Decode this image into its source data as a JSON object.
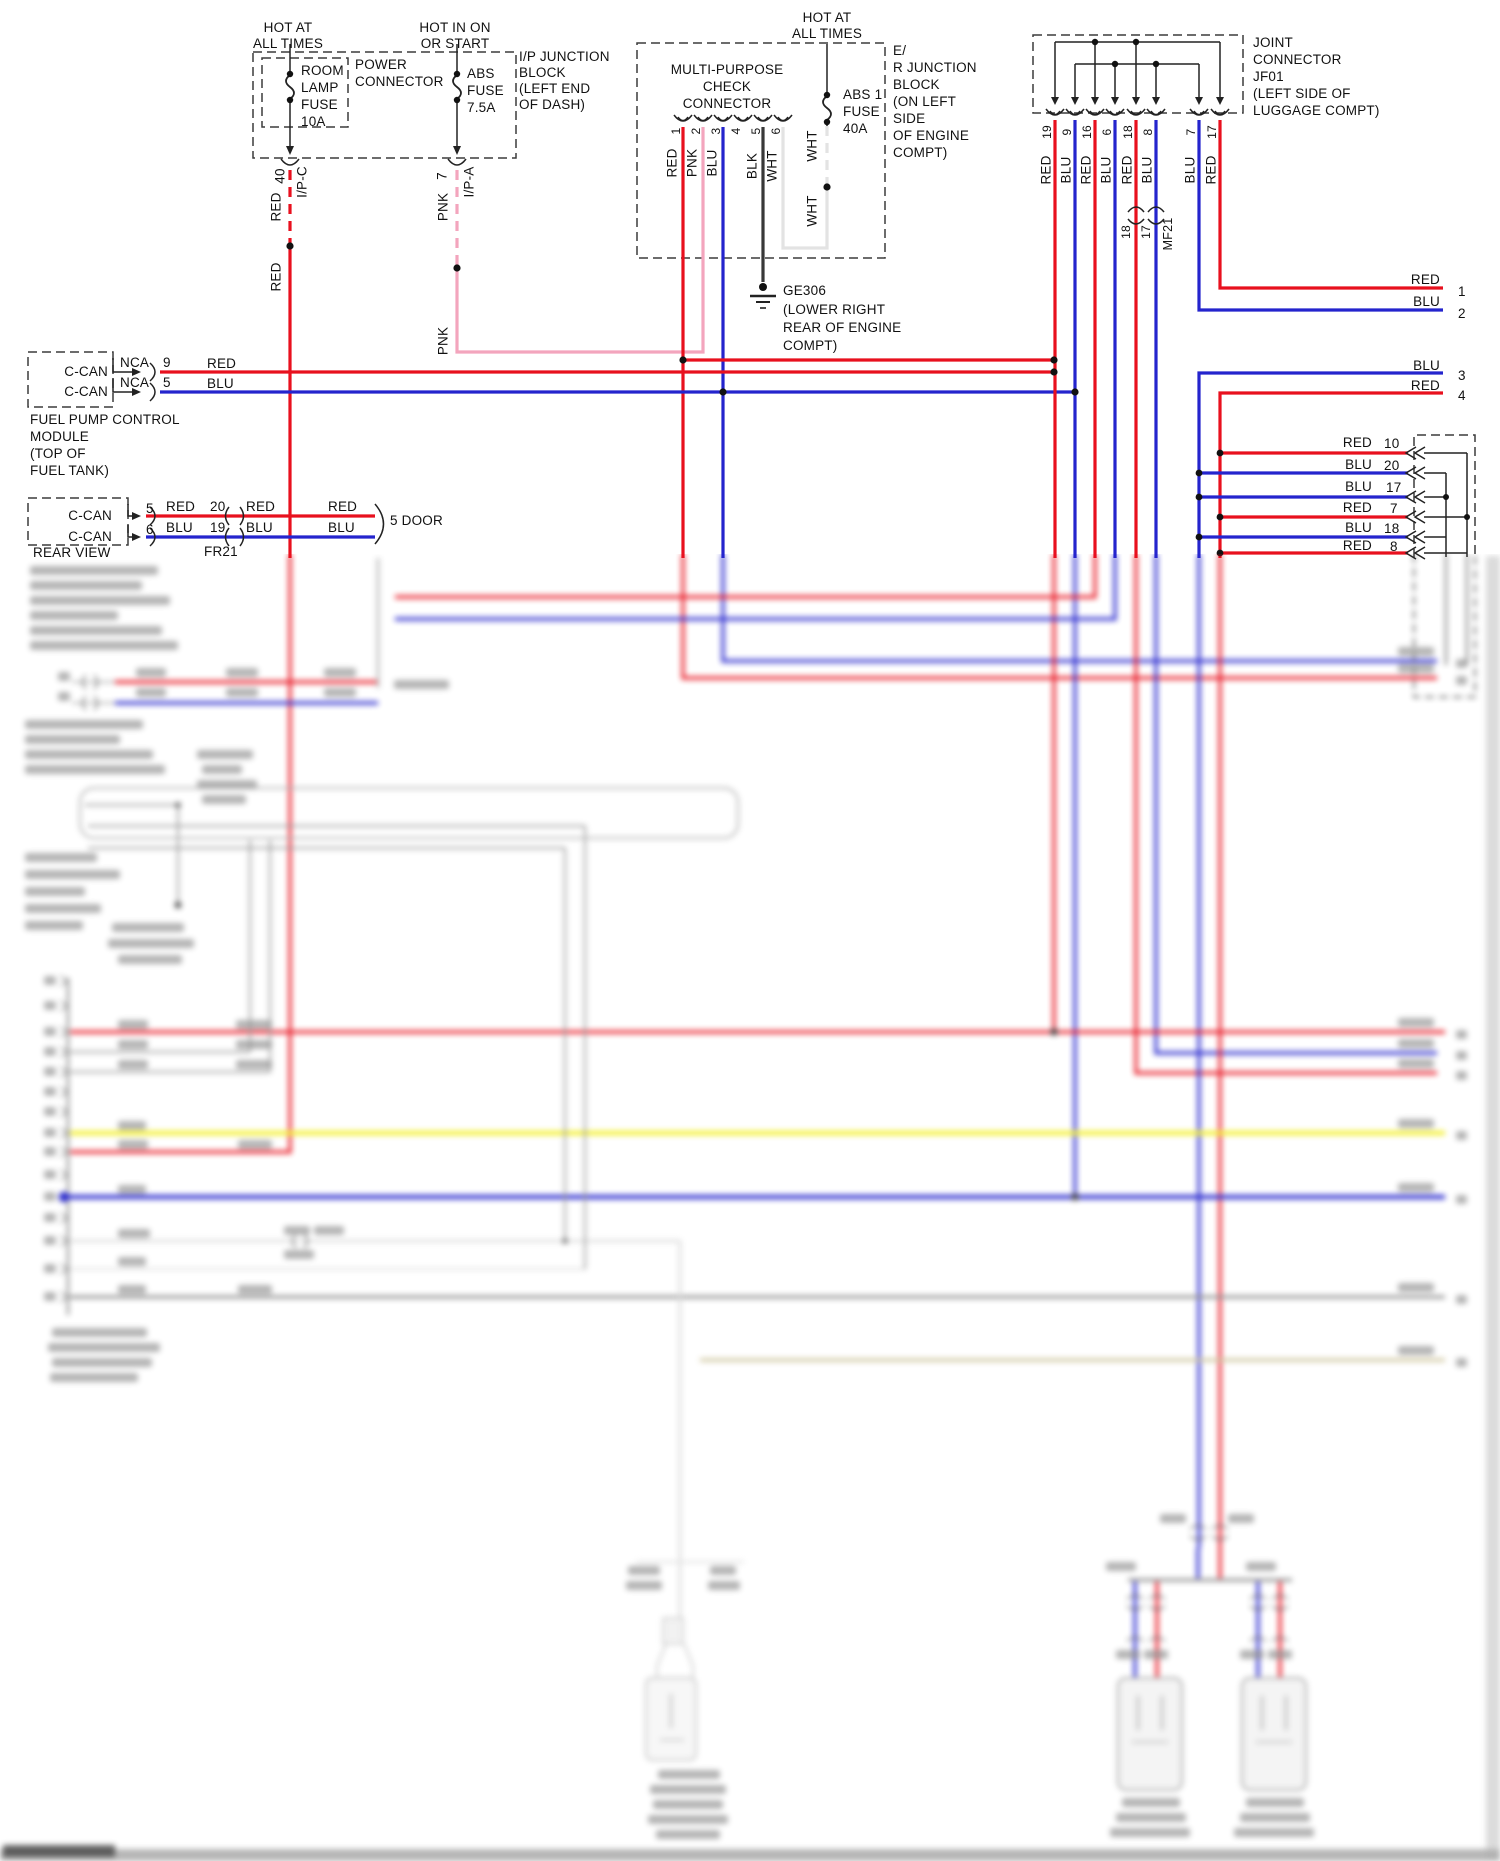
{
  "colors": {
    "red": "#e8101e",
    "blu": "#2424cd",
    "pnk": "#f3a5bd",
    "wht": "#e3e3e3",
    "blk": "#383838",
    "line": "#222222",
    "yel": "#f2ee1f",
    "gry": "#8f8f8f",
    "tan": "#cdc39a",
    "blob": "#8a8a8a",
    "boxline": "#3c3c3c"
  },
  "components": [
    {
      "name": "ip-junction-block",
      "labels": [
        {
          "t": "HOT AT",
          "x": 288,
          "y": 21,
          "a": "ct"
        },
        {
          "t": "ALL TIMES",
          "x": 288,
          "y": 37,
          "a": "ct"
        },
        {
          "t": "HOT IN ON",
          "x": 455,
          "y": 21,
          "a": "ct"
        },
        {
          "t": "OR START",
          "x": 455,
          "y": 37,
          "a": "ct"
        },
        {
          "t": "ROOM",
          "x": 301,
          "y": 64
        },
        {
          "t": "LAMP",
          "x": 301,
          "y": 81
        },
        {
          "t": "FUSE",
          "x": 301,
          "y": 98
        },
        {
          "t": "10A",
          "x": 301,
          "y": 115
        },
        {
          "t": "POWER",
          "x": 355,
          "y": 58
        },
        {
          "t": "CONNECTOR",
          "x": 355,
          "y": 75
        },
        {
          "t": "ABS",
          "x": 467,
          "y": 67
        },
        {
          "t": "FUSE",
          "x": 467,
          "y": 84
        },
        {
          "t": "7.5A",
          "x": 467,
          "y": 101
        },
        {
          "t": "I/P JUNCTION",
          "x": 519,
          "y": 50
        },
        {
          "t": "BLOCK",
          "x": 519,
          "y": 66
        },
        {
          "t": "(LEFT END",
          "x": 519,
          "y": 82
        },
        {
          "t": "OF DASH)",
          "x": 519,
          "y": 98
        },
        {
          "t": "40",
          "x": 280,
          "y": 176,
          "r": 1
        },
        {
          "t": "I/P-C",
          "x": 302,
          "y": 182,
          "r": 1
        },
        {
          "t": "RED",
          "x": 276,
          "y": 207,
          "r": 1
        },
        {
          "t": "RED",
          "x": 276,
          "y": 277,
          "r": 1
        },
        {
          "t": "7",
          "x": 442,
          "y": 176,
          "r": 1
        },
        {
          "t": "I/P-A",
          "x": 469,
          "y": 182,
          "r": 1
        },
        {
          "t": "PNK",
          "x": 443,
          "y": 207,
          "r": 1
        },
        {
          "t": "PNK",
          "x": 443,
          "y": 341,
          "r": 1
        }
      ]
    },
    {
      "name": "er-junction-block",
      "labels": [
        {
          "t": "HOT AT",
          "x": 827,
          "y": 11,
          "a": "ct"
        },
        {
          "t": "ALL TIMES",
          "x": 827,
          "y": 27,
          "a": "ct"
        },
        {
          "t": "MULTI-PURPOSE",
          "x": 727,
          "y": 63,
          "a": "ct"
        },
        {
          "t": "CHECK",
          "x": 727,
          "y": 80,
          "a": "ct"
        },
        {
          "t": "CONNECTOR",
          "x": 727,
          "y": 97,
          "a": "ct"
        },
        {
          "t": "1",
          "x": 676,
          "y": 131,
          "r": 1,
          "s": 12
        },
        {
          "t": "2",
          "x": 696,
          "y": 131,
          "r": 1,
          "s": 12
        },
        {
          "t": "3",
          "x": 716,
          "y": 131,
          "r": 1,
          "s": 12
        },
        {
          "t": "4",
          "x": 736,
          "y": 131,
          "r": 1,
          "s": 12
        },
        {
          "t": "5",
          "x": 756,
          "y": 131,
          "r": 1,
          "s": 12
        },
        {
          "t": "6",
          "x": 776,
          "y": 131,
          "r": 1,
          "s": 12
        },
        {
          "t": "RED",
          "x": 672,
          "y": 163,
          "r": 1
        },
        {
          "t": "PNK",
          "x": 692,
          "y": 163,
          "r": 1
        },
        {
          "t": "BLU",
          "x": 712,
          "y": 163,
          "r": 1
        },
        {
          "t": "BLK",
          "x": 752,
          "y": 166,
          "r": 1
        },
        {
          "t": "WHT",
          "x": 772,
          "y": 166,
          "r": 1
        },
        {
          "t": "ABS 1",
          "x": 843,
          "y": 88
        },
        {
          "t": "FUSE",
          "x": 843,
          "y": 105
        },
        {
          "t": "40A",
          "x": 843,
          "y": 122
        },
        {
          "t": "WHT",
          "x": 812,
          "y": 146,
          "r": 1
        },
        {
          "t": "WHT",
          "x": 812,
          "y": 211,
          "r": 1
        },
        {
          "t": "E/",
          "x": 893,
          "y": 44
        },
        {
          "t": "R JUNCTION",
          "x": 893,
          "y": 61
        },
        {
          "t": "BLOCK",
          "x": 893,
          "y": 78
        },
        {
          "t": "(ON LEFT",
          "x": 893,
          "y": 95
        },
        {
          "t": "SIDE",
          "x": 893,
          "y": 112
        },
        {
          "t": "OF ENGINE",
          "x": 893,
          "y": 129
        },
        {
          "t": "COMPT)",
          "x": 893,
          "y": 146
        }
      ]
    },
    {
      "name": "ge306-ground",
      "labels": [
        {
          "t": "GE306",
          "x": 783,
          "y": 284
        },
        {
          "t": "(LOWER RIGHT",
          "x": 783,
          "y": 303
        },
        {
          "t": "REAR OF ENGINE",
          "x": 783,
          "y": 321
        },
        {
          "t": "COMPT)",
          "x": 783,
          "y": 339
        }
      ]
    },
    {
      "name": "jf01-joint-connector",
      "labels": [
        {
          "t": "JOINT",
          "x": 1253,
          "y": 36
        },
        {
          "t": "CONNECTOR",
          "x": 1253,
          "y": 53
        },
        {
          "t": "JF01",
          "x": 1253,
          "y": 70
        },
        {
          "t": "(LEFT SIDE OF",
          "x": 1253,
          "y": 87
        },
        {
          "t": "LUGGAGE COMPT)",
          "x": 1253,
          "y": 104
        },
        {
          "t": "19",
          "x": 1047,
          "y": 132,
          "r": 1,
          "s": 12
        },
        {
          "t": "9",
          "x": 1067,
          "y": 132,
          "r": 1,
          "s": 12
        },
        {
          "t": "16",
          "x": 1087,
          "y": 132,
          "r": 1,
          "s": 12
        },
        {
          "t": "6",
          "x": 1107,
          "y": 132,
          "r": 1,
          "s": 12
        },
        {
          "t": "18",
          "x": 1128,
          "y": 132,
          "r": 1,
          "s": 12
        },
        {
          "t": "8",
          "x": 1148,
          "y": 132,
          "r": 1,
          "s": 12
        },
        {
          "t": "7",
          "x": 1191,
          "y": 132,
          "r": 1,
          "s": 12
        },
        {
          "t": "17",
          "x": 1212,
          "y": 132,
          "r": 1,
          "s": 12
        },
        {
          "t": "RED",
          "x": 1046,
          "y": 170,
          "r": 1
        },
        {
          "t": "BLU",
          "x": 1066,
          "y": 170,
          "r": 1
        },
        {
          "t": "RED",
          "x": 1086,
          "y": 170,
          "r": 1
        },
        {
          "t": "BLU",
          "x": 1106,
          "y": 170,
          "r": 1
        },
        {
          "t": "RED",
          "x": 1127,
          "y": 170,
          "r": 1
        },
        {
          "t": "BLU",
          "x": 1147,
          "y": 170,
          "r": 1
        },
        {
          "t": "BLU",
          "x": 1190,
          "y": 170,
          "r": 1
        },
        {
          "t": "RED",
          "x": 1211,
          "y": 170,
          "r": 1
        },
        {
          "t": "18",
          "x": 1126,
          "y": 232,
          "r": 1,
          "s": 12
        },
        {
          "t": "17",
          "x": 1146,
          "y": 232,
          "r": 1,
          "s": 12
        },
        {
          "t": "MF21",
          "x": 1168,
          "y": 234,
          "r": 1,
          "s": 12.5
        }
      ]
    },
    {
      "name": "can-stub-lines",
      "labels": [
        {
          "t": "RED",
          "x": 1440,
          "y": 273,
          "a": "rt"
        },
        {
          "t": "1",
          "x": 1458,
          "y": 285
        },
        {
          "t": "BLU",
          "x": 1440,
          "y": 295,
          "a": "rt"
        },
        {
          "t": "2",
          "x": 1458,
          "y": 307
        },
        {
          "t": "BLU",
          "x": 1440,
          "y": 359,
          "a": "rt"
        },
        {
          "t": "3",
          "x": 1458,
          "y": 369
        },
        {
          "t": "RED",
          "x": 1440,
          "y": 379,
          "a": "rt"
        },
        {
          "t": "4",
          "x": 1458,
          "y": 389
        }
      ]
    },
    {
      "name": "k-joint-connector",
      "labels": [
        {
          "t": "RED",
          "x": 1372,
          "y": 436,
          "a": "rt"
        },
        {
          "t": "10",
          "x": 1384,
          "y": 437
        },
        {
          "t": "BLU",
          "x": 1372,
          "y": 458,
          "a": "rt"
        },
        {
          "t": "20",
          "x": 1384,
          "y": 459
        },
        {
          "t": "BLU",
          "x": 1372,
          "y": 480,
          "a": "rt"
        },
        {
          "t": "17",
          "x": 1386,
          "y": 481
        },
        {
          "t": "RED",
          "x": 1372,
          "y": 501,
          "a": "rt"
        },
        {
          "t": "7",
          "x": 1390,
          "y": 502
        },
        {
          "t": "BLU",
          "x": 1372,
          "y": 521,
          "a": "rt"
        },
        {
          "t": "18",
          "x": 1384,
          "y": 522
        },
        {
          "t": "RED",
          "x": 1372,
          "y": 539,
          "a": "rt"
        },
        {
          "t": "8",
          "x": 1390,
          "y": 540
        }
      ]
    },
    {
      "name": "fuel-pump-module",
      "labels": [
        {
          "t": "C-CAN",
          "x": 108,
          "y": 365,
          "a": "rt"
        },
        {
          "t": "C-CAN",
          "x": 108,
          "y": 385,
          "a": "rt"
        },
        {
          "t": "NCA",
          "x": 120,
          "y": 356
        },
        {
          "t": "NCA",
          "x": 120,
          "y": 376
        },
        {
          "t": "9",
          "x": 163,
          "y": 356
        },
        {
          "t": "5",
          "x": 163,
          "y": 376
        },
        {
          "t": "RED",
          "x": 207,
          "y": 357
        },
        {
          "t": "BLU",
          "x": 207,
          "y": 377
        },
        {
          "t": "FUEL PUMP CONTROL",
          "x": 30,
          "y": 413
        },
        {
          "t": "MODULE",
          "x": 30,
          "y": 430
        },
        {
          "t": "(TOP OF",
          "x": 30,
          "y": 447
        },
        {
          "t": "FUEL TANK)",
          "x": 30,
          "y": 464
        }
      ]
    },
    {
      "name": "rear-view-module",
      "labels": [
        {
          "t": "C-CAN",
          "x": 112,
          "y": 509,
          "a": "rt"
        },
        {
          "t": "C-CAN",
          "x": 112,
          "y": 530,
          "a": "rt"
        },
        {
          "t": "5",
          "x": 146,
          "y": 502
        },
        {
          "t": "6",
          "x": 146,
          "y": 523
        },
        {
          "t": "RED",
          "x": 166,
          "y": 500
        },
        {
          "t": "20",
          "x": 210,
          "y": 500
        },
        {
          "t": "RED",
          "x": 246,
          "y": 500
        },
        {
          "t": "RED",
          "x": 328,
          "y": 500
        },
        {
          "t": "BLU",
          "x": 166,
          "y": 521
        },
        {
          "t": "19",
          "x": 210,
          "y": 521
        },
        {
          "t": "BLU",
          "x": 246,
          "y": 521
        },
        {
          "t": "BLU",
          "x": 328,
          "y": 521
        },
        {
          "t": "FR21",
          "x": 204,
          "y": 545
        },
        {
          "t": "5 DOOR",
          "x": 390,
          "y": 514
        },
        {
          "t": "REAR VIEW",
          "x": 33,
          "y": 546
        }
      ]
    }
  ]
}
